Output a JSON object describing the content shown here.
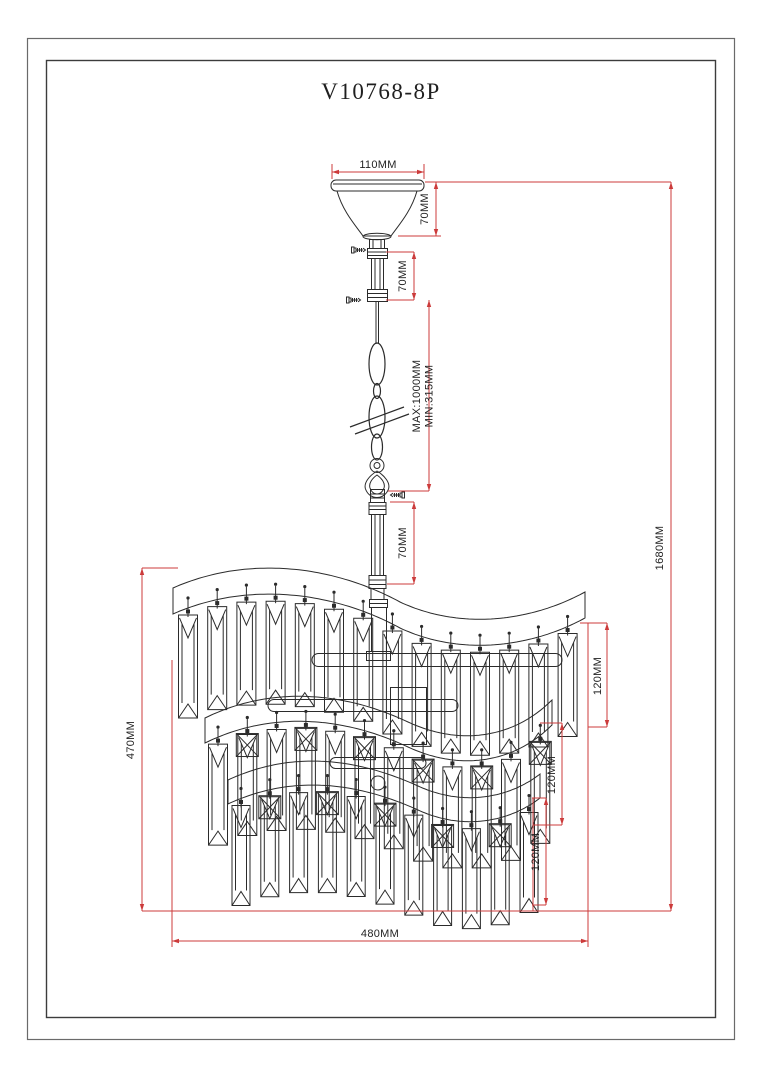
{
  "title": "V10768-8P",
  "annotations": {
    "canopy_width": "110MM",
    "canopy_height": "70MM",
    "upper_rod": "70MM",
    "chain_max": "MAX:1000MM",
    "chain_min": "MIN:315MM",
    "lower_rod": "70MM",
    "overall_height": "1680MM",
    "body_height": "470MM",
    "body_width": "480MM",
    "tier1_crystal": "120MM",
    "tier2_crystal": "120MM",
    "tier3_crystal": "120MM"
  },
  "colors": {
    "line": "#2b2b2b",
    "dimension": "#cc3b3b",
    "text": "#1f1f1f",
    "background": "#ffffff"
  }
}
